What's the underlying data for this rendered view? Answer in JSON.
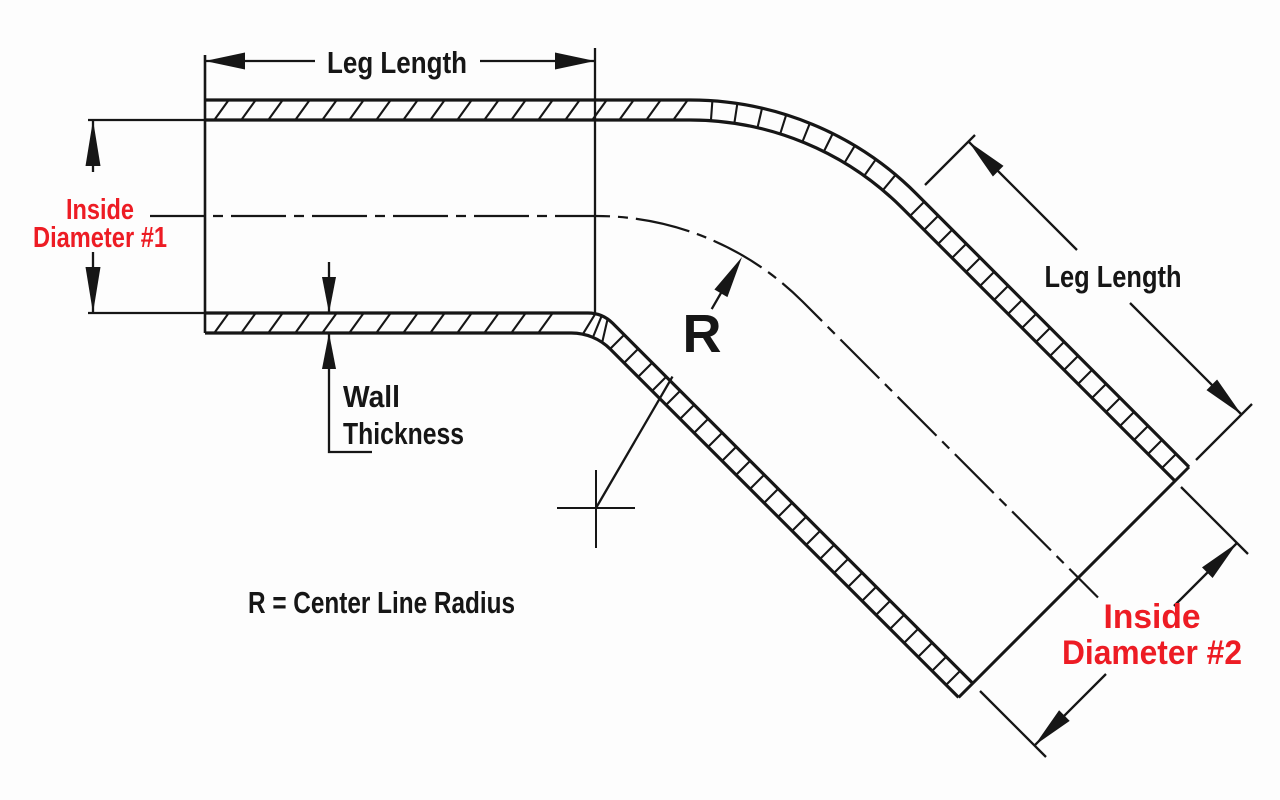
{
  "diagram": {
    "title": "45-degree reducer elbow dimension drawing",
    "colors": {
      "paper": "#fdfdfd",
      "ink": "#161616",
      "red": "#ED1C24"
    },
    "labels": {
      "leg_length_top": "Leg Length",
      "leg_length_right": "Leg Length",
      "inside_diameter_1_line1": "Inside",
      "inside_diameter_1_line2": "Diameter #1",
      "inside_diameter_2_line1": "Inside",
      "inside_diameter_2_line2": "Diameter #2",
      "wall_thickness_line1": "Wall",
      "wall_thickness_line2": "Thickness",
      "radius_symbol": "R",
      "radius_legend": "R = Center Line Radius"
    }
  }
}
